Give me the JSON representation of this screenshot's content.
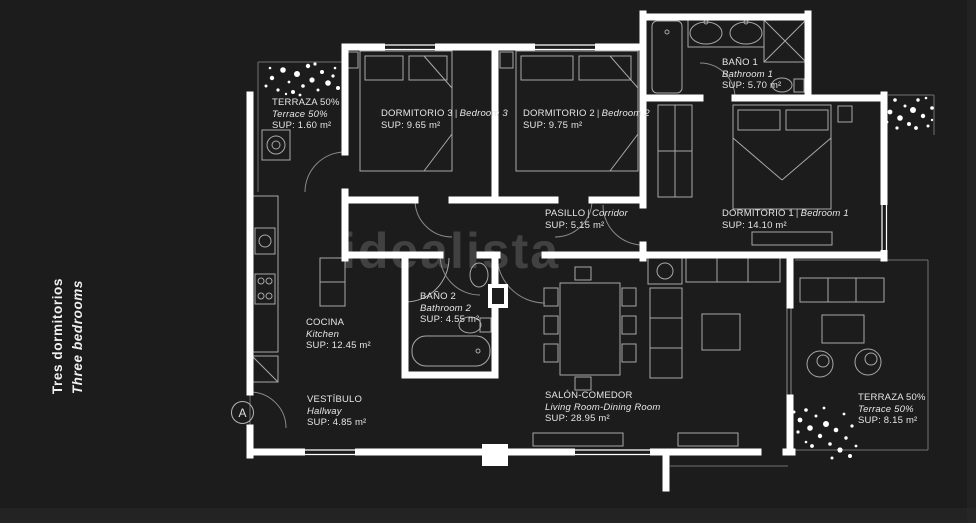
{
  "watermark": "idealista",
  "separator": "|",
  "entrance_marker": "A",
  "title": {
    "es": "Tres dormitorios",
    "en": "Three bedrooms"
  },
  "colors": {
    "background": "#1c1c1c",
    "walls": "#ffffff",
    "furniture_lines": "#a8a8a8",
    "label_text": "#e6e6e6",
    "watermark": "#787878"
  },
  "rooms": [
    {
      "id": "terraza-top-left",
      "name_es": "TERRAZA 50%",
      "name_en": "Terrace 50%",
      "area": "SUP: 1.60 m²"
    },
    {
      "id": "dormitorio-3",
      "name_es": "DORMITORIO 3",
      "name_en": "Bedroom 3",
      "area": "SUP: 9.65 m²"
    },
    {
      "id": "dormitorio-2",
      "name_es": "DORMITORIO 2",
      "name_en": "Bedroom 2",
      "area": "SUP: 9.75 m²"
    },
    {
      "id": "bano-1",
      "name_es": "BAÑO 1",
      "name_en": "Bathroom 1",
      "area": "SUP: 5.70 m²"
    },
    {
      "id": "pasillo",
      "name_es": "PASILLO",
      "name_en": "Corridor",
      "area": "SUP: 5.15 m²"
    },
    {
      "id": "dormitorio-1",
      "name_es": "DORMITORIO 1",
      "name_en": "Bedroom 1",
      "area": "SUP: 14.10 m²"
    },
    {
      "id": "bano-2",
      "name_es": "BAÑO 2",
      "name_en": "Bathroom 2",
      "area": "SUP: 4.55 m²"
    },
    {
      "id": "cocina",
      "name_es": "COCINA",
      "name_en": "Kitchen",
      "area": "SUP: 12.45 m²"
    },
    {
      "id": "vestibulo",
      "name_es": "VESTÍBULO",
      "name_en": "Hallway",
      "area": "SUP: 4.85 m²"
    },
    {
      "id": "salon-comedor",
      "name_es": "SALÓN-COMEDOR",
      "name_en": "Living Room-Dining Room",
      "area": "SUP: 28.95 m²"
    },
    {
      "id": "terraza-bottom-right",
      "name_es": "TERRAZA 50%",
      "name_en": "Terrace 50%",
      "area": "SUP: 8.15 m²"
    }
  ]
}
